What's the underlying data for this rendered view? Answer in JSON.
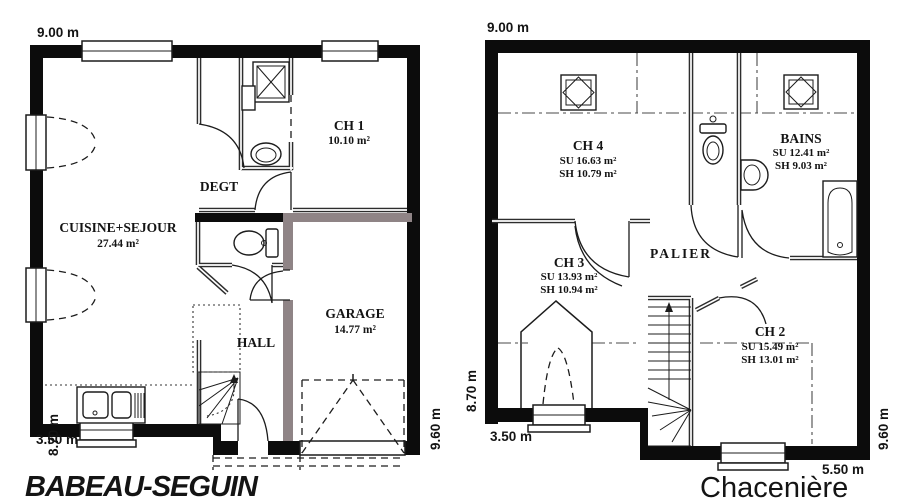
{
  "branding": {
    "company": "BABEAU-SEGUIN",
    "company_color": "#a6242b",
    "model": "Chacenière",
    "model_color": "#ee4b3d"
  },
  "palette": {
    "outer_wall": "#0c0c0c",
    "garage_partition_wall": "#8f8486"
  },
  "ground_floor": {
    "dim_top": "9.00 m",
    "dim_left": "8.70 m",
    "dim_bottom_left": "3.50 m",
    "dim_right": "9.60 m",
    "rooms": {
      "ch1": {
        "name": "CH 1",
        "area": "10.10 m²"
      },
      "degt": {
        "name": "DEGT"
      },
      "cuisine": {
        "name": "CUISINE+SEJOUR",
        "area": "27.44 m²"
      },
      "hall": {
        "name": "HALL"
      },
      "garage": {
        "name": "GARAGE",
        "area": "14.77 m²"
      }
    }
  },
  "upper_floor": {
    "dim_top": "9.00 m",
    "dim_left": "8.70 m",
    "dim_bottom_left": "3.50 m",
    "dim_right": "9.60 m",
    "dim_bottom_right": "5.50 m",
    "rooms": {
      "ch4": {
        "name": "CH 4",
        "su": "SU 16.63 m²",
        "sh": "SH 10.79 m²"
      },
      "bains": {
        "name": "BAINS",
        "su": "SU 12.41 m²",
        "sh": "SH 9.03 m²"
      },
      "palier": {
        "name": "PALIER"
      },
      "ch3": {
        "name": "CH 3",
        "su": "SU 13.93 m²",
        "sh": "SH 10.94 m²"
      },
      "ch2": {
        "name": "CH 2",
        "su": "SU 15.49 m²",
        "sh": "SH 13.01 m²"
      }
    }
  }
}
